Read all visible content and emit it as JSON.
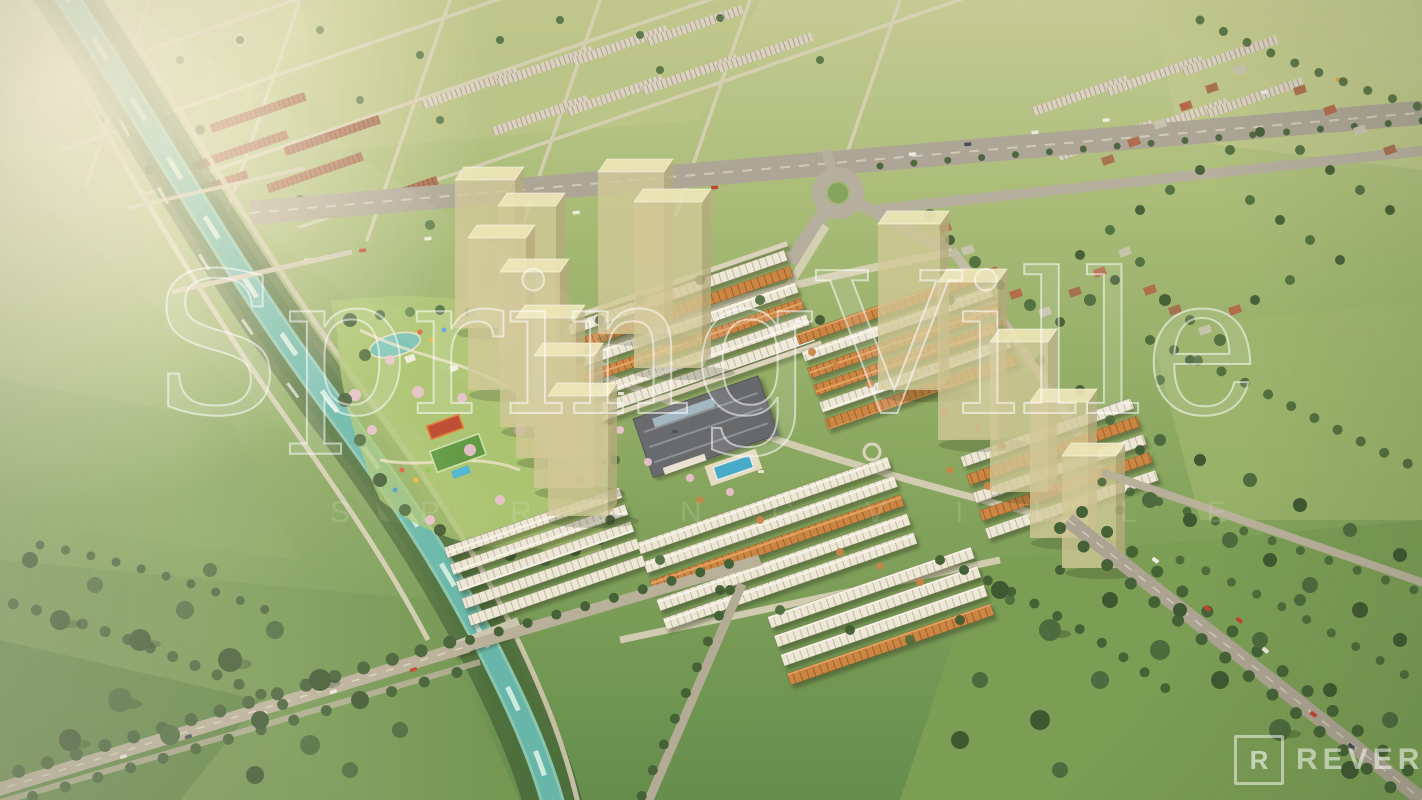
{
  "scene": {
    "kind": "aerial-masterplan-render"
  },
  "watermark": {
    "text": "SpringVille",
    "subtitle": "SPRINGVILLE",
    "color": "#FFFFFF"
  },
  "logo": {
    "mark": "R",
    "wordmark": "REVER"
  },
  "palette": {
    "field_light": "#b9c489",
    "field_mid": "#7fa35c",
    "meadow_dark": "#55803f",
    "canal_teal": "#5fb5ab",
    "road_light": "#cfc8b2",
    "asphalt": "#a9a396",
    "roof_white": "#ece8db",
    "roof_orange": "#c9823f",
    "roof_brown": "#a5654a",
    "tower_glass": "#cfc79b",
    "tree_dark": "#36522e",
    "cherry_pink": "#ecc2d5",
    "pool_blue": "#3fa9cc",
    "clubhouse_roof": "#5e646b",
    "flare_warm": "#fff6dd"
  }
}
